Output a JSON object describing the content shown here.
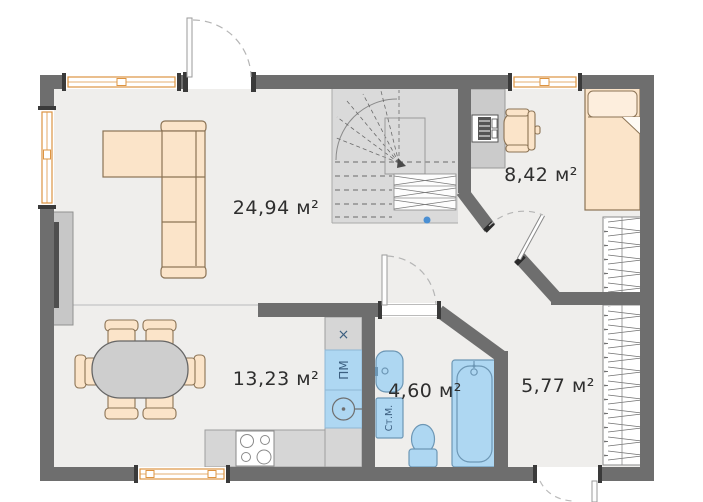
{
  "floor_plan": {
    "rooms": [
      {
        "name": "living-room",
        "area": "24,94 м²"
      },
      {
        "name": "bedroom",
        "area": "8,42 м²"
      },
      {
        "name": "kitchen-dining",
        "area": "13,23 м²"
      },
      {
        "name": "bathroom",
        "area": "4,60 м²"
      },
      {
        "name": "hallway",
        "area": "5,77 м²"
      }
    ],
    "appliance_labels": {
      "dishwasher": "ПМ",
      "washing_machine": "Ст.М.",
      "hob": "×"
    },
    "colors": {
      "wall": "#6e6e6e",
      "floor": "#efeeec",
      "furniture": "#fbe4c9",
      "plumbing": "#aed7f2",
      "window_frame": "#dd9442",
      "stairs": "#dadada"
    }
  }
}
